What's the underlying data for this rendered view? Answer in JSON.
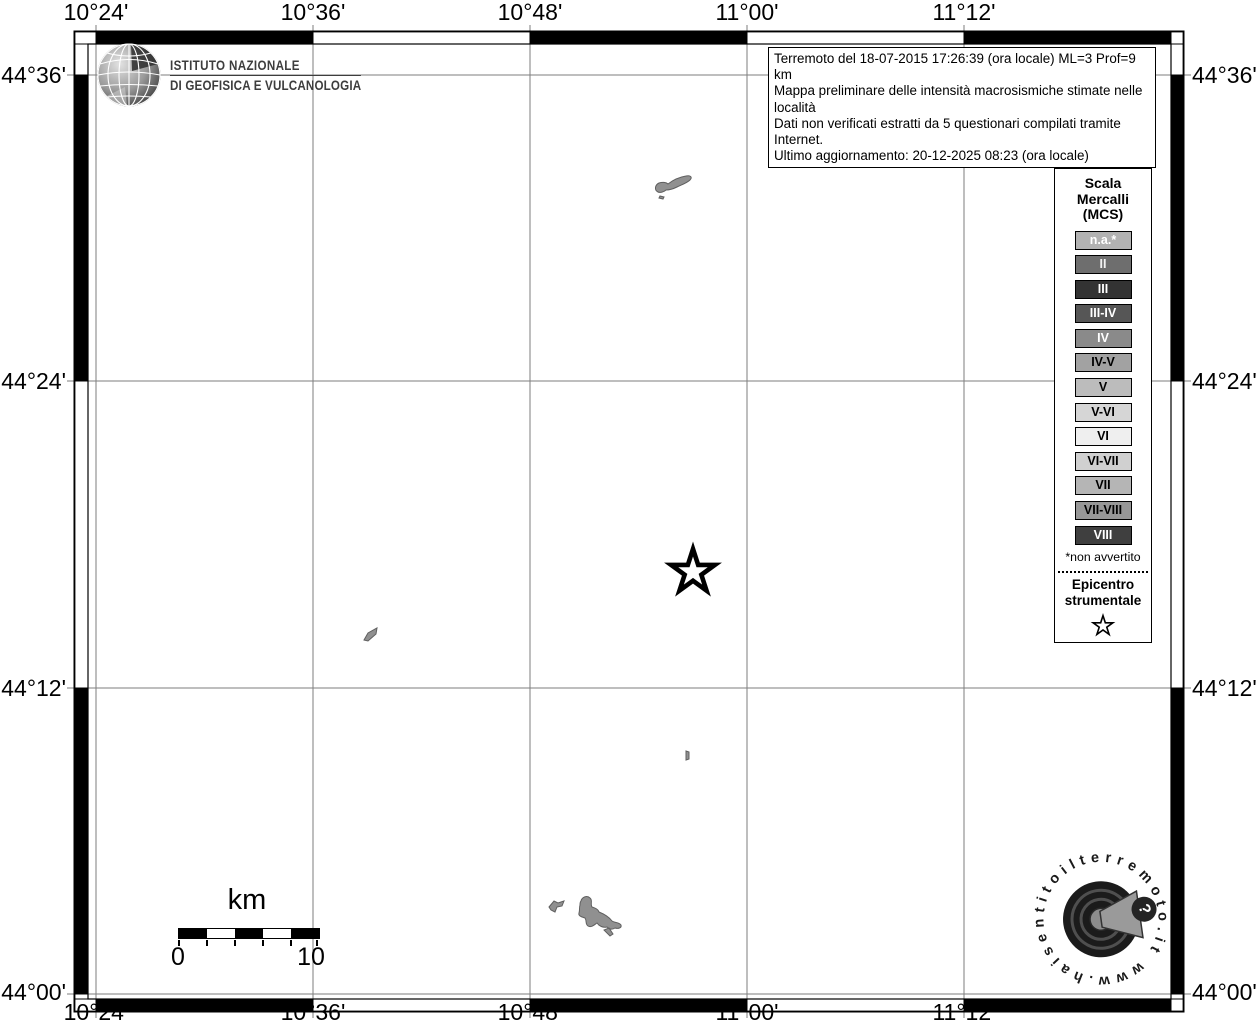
{
  "info_box": {
    "lines": [
      "Terremoto del 18-07-2015 17:26:39 (ora locale) ML=3 Prof=9 km",
      "Mappa preliminare delle intensità macrosismiche stimate nelle località",
      "Dati non verificati estratti da 5 questionari compilati tramite Internet.",
      "Ultimo aggiornamento: 20-12-2025 08:23 (ora locale)"
    ]
  },
  "ingv_logo": {
    "line1": "ISTITUTO NAZIONALE",
    "line2": "DI GEOFISICA E VULCANOLOGIA"
  },
  "axis_labels": {
    "top": [
      "10°24'",
      "10°36'",
      "10°48'",
      "11°00'",
      "11°12'"
    ],
    "bottom": [
      "10°24'",
      "10°36'",
      "10°48'",
      "11°00'",
      "11°12'"
    ],
    "left": [
      "44°36'",
      "44°24'",
      "44°12'",
      "44°00'"
    ],
    "right": [
      "44°36'",
      "44°24'",
      "44°12'",
      "44°00'"
    ]
  },
  "legend": {
    "title_lines": [
      "Scala",
      "Mercalli",
      "(MCS)"
    ],
    "items": [
      {
        "label": "n.a.*",
        "bg": "#b2b2b2",
        "fg": "#ffffff"
      },
      {
        "label": "II",
        "bg": "#6e6e6e",
        "fg": "#f2f2f2"
      },
      {
        "label": "III",
        "bg": "#333333",
        "fg": "#ffffff"
      },
      {
        "label": "III-IV",
        "bg": "#565656",
        "fg": "#ffffff"
      },
      {
        "label": "IV",
        "bg": "#8a8a8a",
        "fg": "#ffffff"
      },
      {
        "label": "IV-V",
        "bg": "#a2a2a2",
        "fg": "#000000"
      },
      {
        "label": "V",
        "bg": "#bcbcbc",
        "fg": "#000000"
      },
      {
        "label": "V-VI",
        "bg": "#d6d6d6",
        "fg": "#000000"
      },
      {
        "label": "VI",
        "bg": "#efefef",
        "fg": "#000000"
      },
      {
        "label": "VI-VII",
        "bg": "#d0d0d0",
        "fg": "#000000"
      },
      {
        "label": "VII",
        "bg": "#b5b5b5",
        "fg": "#000000"
      },
      {
        "label": "VII-VIII",
        "bg": "#979797",
        "fg": "#000000"
      },
      {
        "label": "VIII",
        "bg": "#3f3f3f",
        "fg": "#ffffff"
      }
    ],
    "footnote": "*non avvertito",
    "epicenter_lines": [
      "Epicentro",
      "strumentale"
    ]
  },
  "scale_bar": {
    "unit": "km",
    "start": "0",
    "end": "10"
  },
  "watermark": {
    "circular_text": "www.haisentitoilterremoto.it",
    "question_mark": "?"
  },
  "colors": {
    "map_feature_fill": "#909090",
    "map_feature_stroke": "#5f5f5f",
    "gridline": "#7d7d7d",
    "frame_black": "#000000"
  }
}
